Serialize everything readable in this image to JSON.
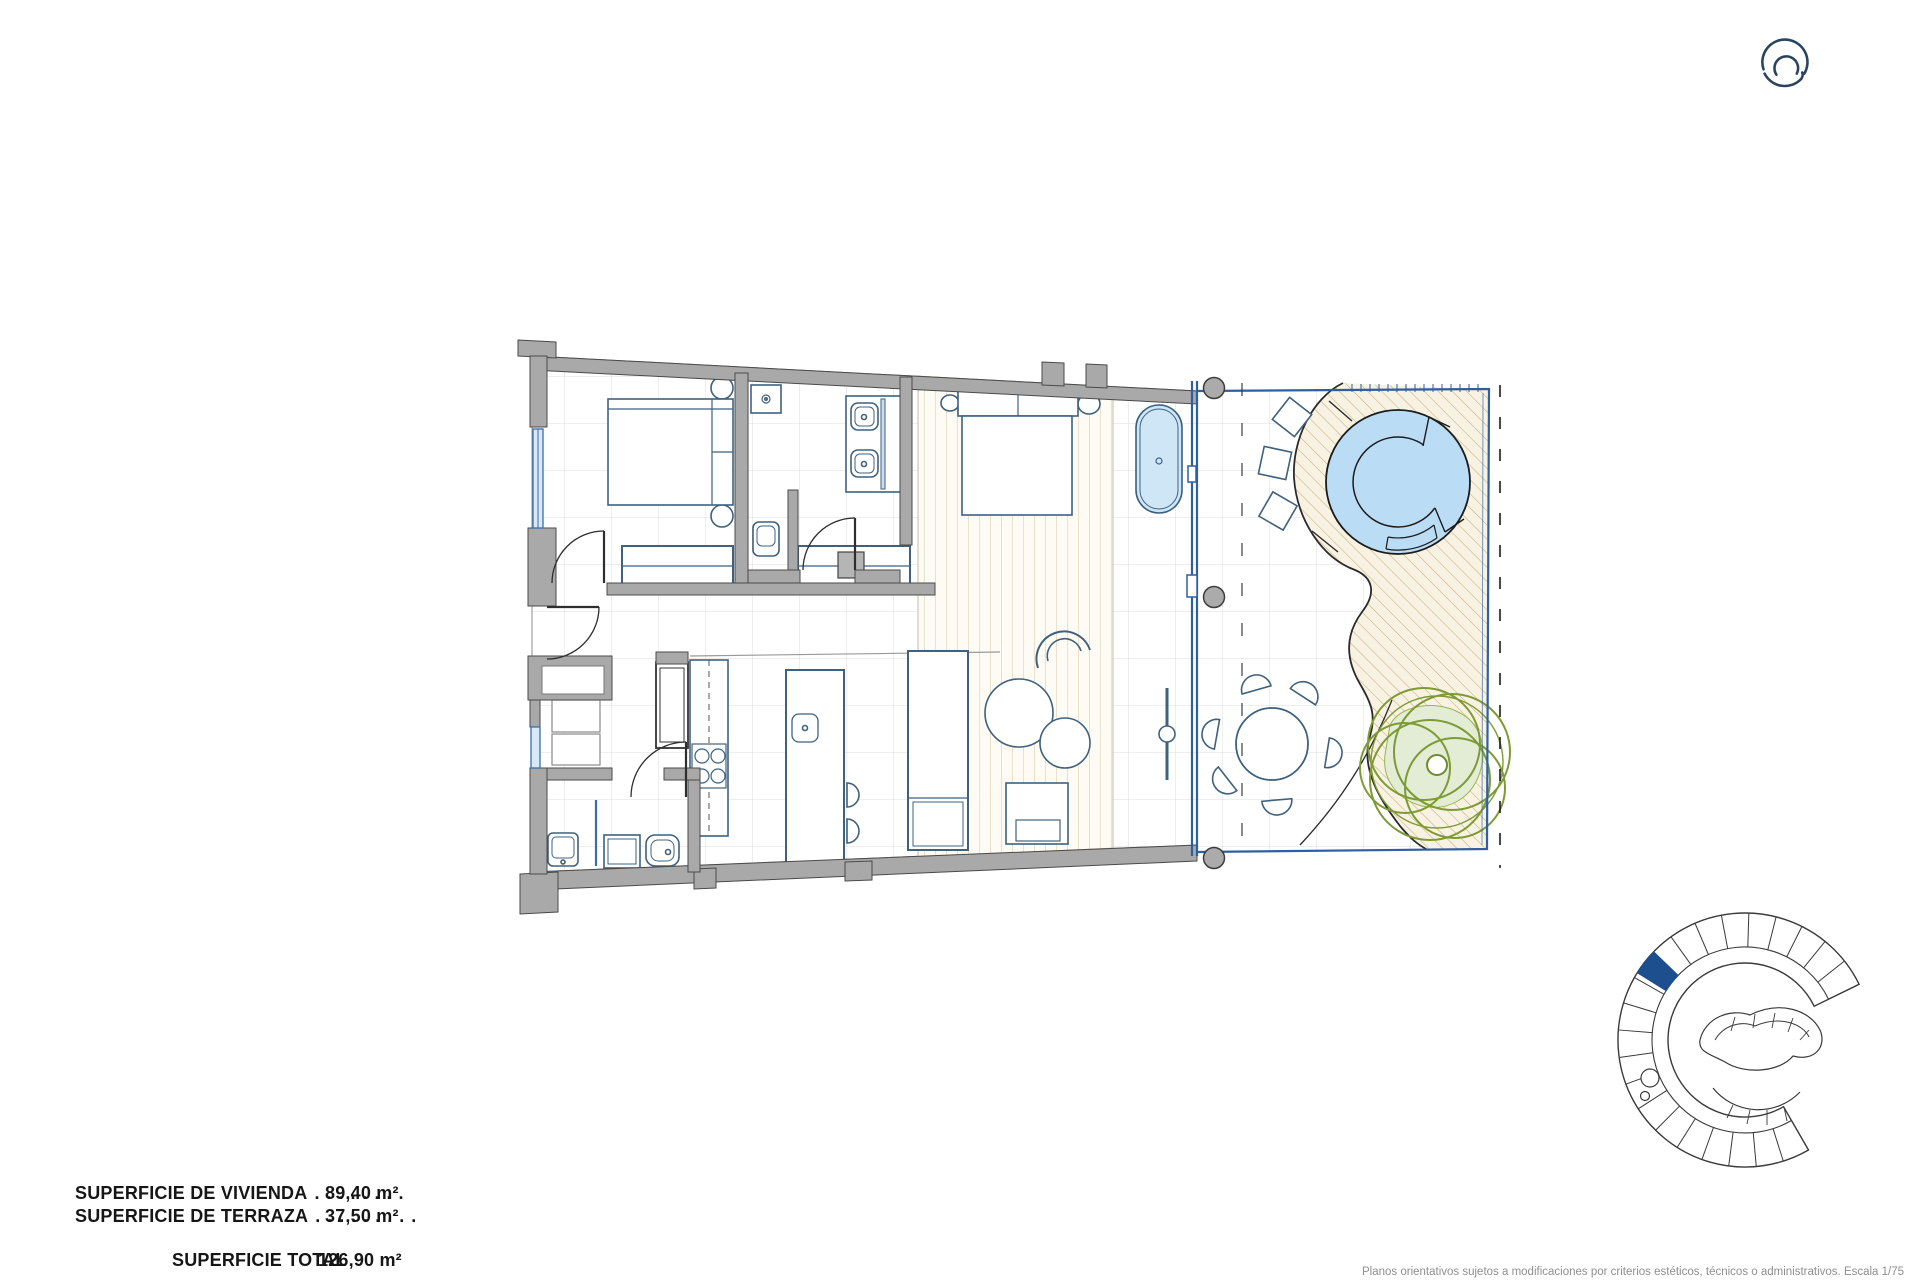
{
  "areas": {
    "rows": [
      {
        "label": "SUPERFICIE DE VIVIENDA",
        "leader": ". . . . . . . .",
        "value": "89,40 m²"
      },
      {
        "label": "SUPERFICIE DE TERRAZA",
        "leader": ". . . . . . . . .",
        "value": "37,50 m²"
      }
    ],
    "total_row": {
      "label": "SUPERFICIE TOTAL",
      "value": "126,90 m²"
    }
  },
  "footer": {
    "disclaimer": "Planos orientativos sujetos a modificaciones por criterios estéticos, técnicos o administrativos. Escala 1/75"
  },
  "colors": {
    "wall_gray": "#a9a9a9",
    "glass_blue": "#2e5fa3",
    "pool_water": "#badcf4",
    "deck_sand": "#f8f2e2",
    "deck_hatch_line": "#c9ae80",
    "tree_green": "#7d9a35",
    "unit_highlight": "#1d4f8f",
    "logo_navy": "#2a4460",
    "furniture_blue": "#3f617e"
  }
}
